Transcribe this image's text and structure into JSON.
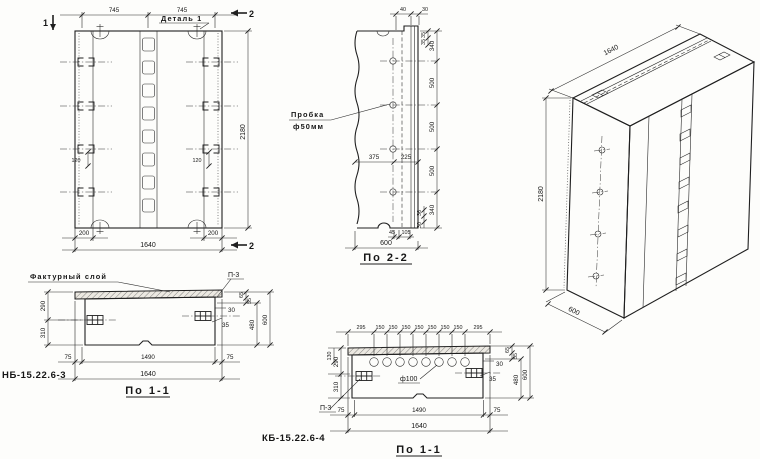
{
  "sheet": {
    "front": {
      "detail_label": "Деталь 1",
      "mark1": "1",
      "mark2_top": "2",
      "mark2_bottom": "2",
      "dim_top": [
        "745",
        "745"
      ],
      "dim_loop": [
        "120",
        "120"
      ],
      "dim_bottom_small": [
        "200",
        "200"
      ],
      "dim_width": "1640",
      "dim_height": "2180"
    },
    "side": {
      "title": "По 2-2",
      "plug_label": [
        "Пробка",
        "ф50мм"
      ],
      "dim_top": [
        "40",
        "30"
      ],
      "dim_right": [
        "340",
        "500",
        "500",
        "500",
        "340"
      ],
      "dim_right_top_small": [
        "35",
        "35"
      ],
      "dim_right_bottom_small": [
        "36",
        "30"
      ],
      "dim_mid": [
        "375",
        "225"
      ],
      "dim_bottom_small": [
        "45",
        "105"
      ],
      "dim_width": "600"
    },
    "iso": {
      "dim_width": "1640",
      "dim_height": "2180",
      "dim_depth": "600"
    },
    "sec3": {
      "code": "НБ-15.22.6-3",
      "title": "По 1-1",
      "facing_label": "Фактурный слой",
      "detail_ref": "П-3",
      "dim_left": [
        "290",
        "310"
      ],
      "dim_right_small": [
        "65",
        "55",
        "30",
        "35"
      ],
      "dim_right": [
        "480",
        "600"
      ],
      "dim_bottom": [
        "75",
        "1490",
        "75"
      ],
      "dim_width": "1640"
    },
    "sec4": {
      "code": "КБ-15.22.6-4",
      "title": "По 1-1",
      "detail_ref": "П-3",
      "hole_label": "ф100",
      "dim_top": [
        "295",
        "150",
        "150",
        "150",
        "150",
        "150",
        "150",
        "150",
        "295"
      ],
      "dim_left": [
        "130",
        "290",
        "310"
      ],
      "dim_right_small": [
        "30",
        "35",
        "65",
        "55"
      ],
      "dim_right": [
        "480",
        "600"
      ],
      "dim_bottom": [
        "75",
        "1490",
        "75"
      ],
      "dim_width": "1640"
    }
  }
}
